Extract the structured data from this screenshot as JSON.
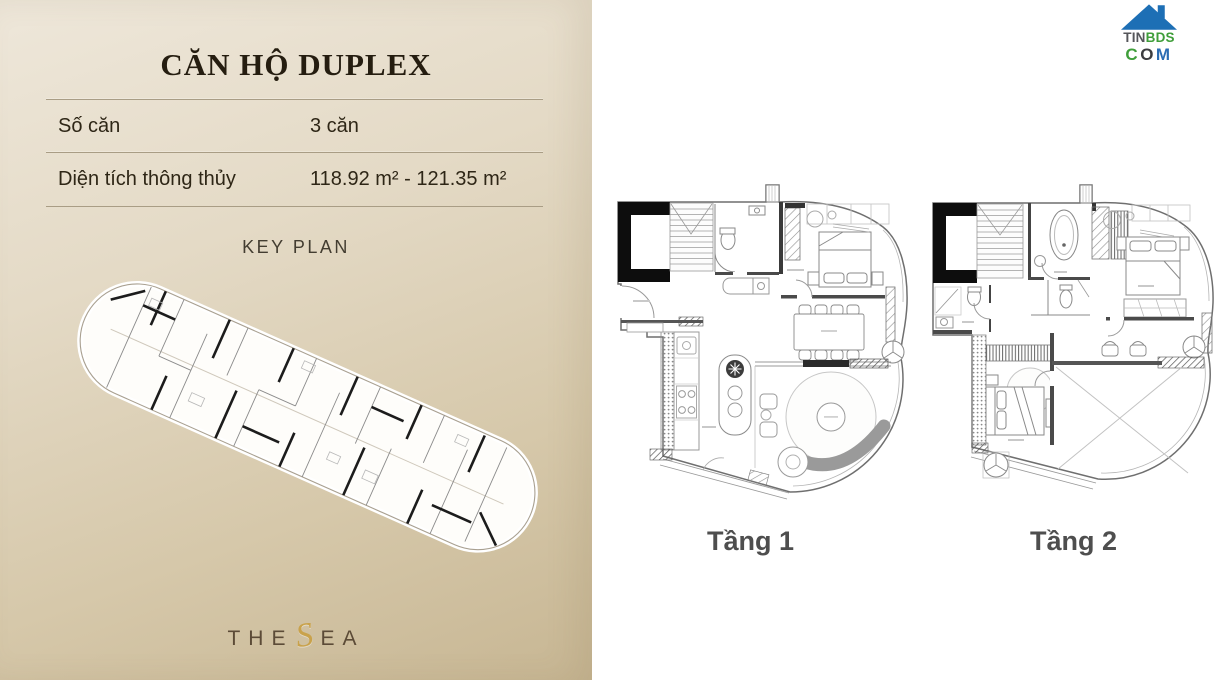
{
  "colors": {
    "panel_gradient_top": "#eee7da",
    "panel_gradient_bottom": "#c7b693",
    "title_text": "#251d10",
    "divider": "#a99d85",
    "body_text": "#2e2616",
    "brand_gold": "#c9a24b",
    "brand_brown": "#5c4b37",
    "floor_label": "#4e4e4e",
    "logo_blue": "#1d6fb5",
    "logo_green": "#3f9e3a",
    "logo_gray": "#55565a",
    "plan_wall_black": "#0d0d0d"
  },
  "left_panel": {
    "title": "CĂN HỘ DUPLEX",
    "rows": [
      {
        "label": "Số căn",
        "value": "3 căn"
      },
      {
        "label": "Diện tích thông thủy",
        "value": "118.92 m² - 121.35 m²"
      }
    ],
    "key_plan_label": "KEY PLAN",
    "brand": {
      "part1": "THE",
      "s": "S",
      "part2": "EA"
    }
  },
  "right_panel": {
    "logo": {
      "row1_part1": "TIN",
      "row1_part2": "BDS",
      "row2_c": "C",
      "row2_o": "O",
      "row2_m": "M"
    },
    "floor_labels": [
      "Tầng 1",
      "Tầng 2"
    ]
  }
}
